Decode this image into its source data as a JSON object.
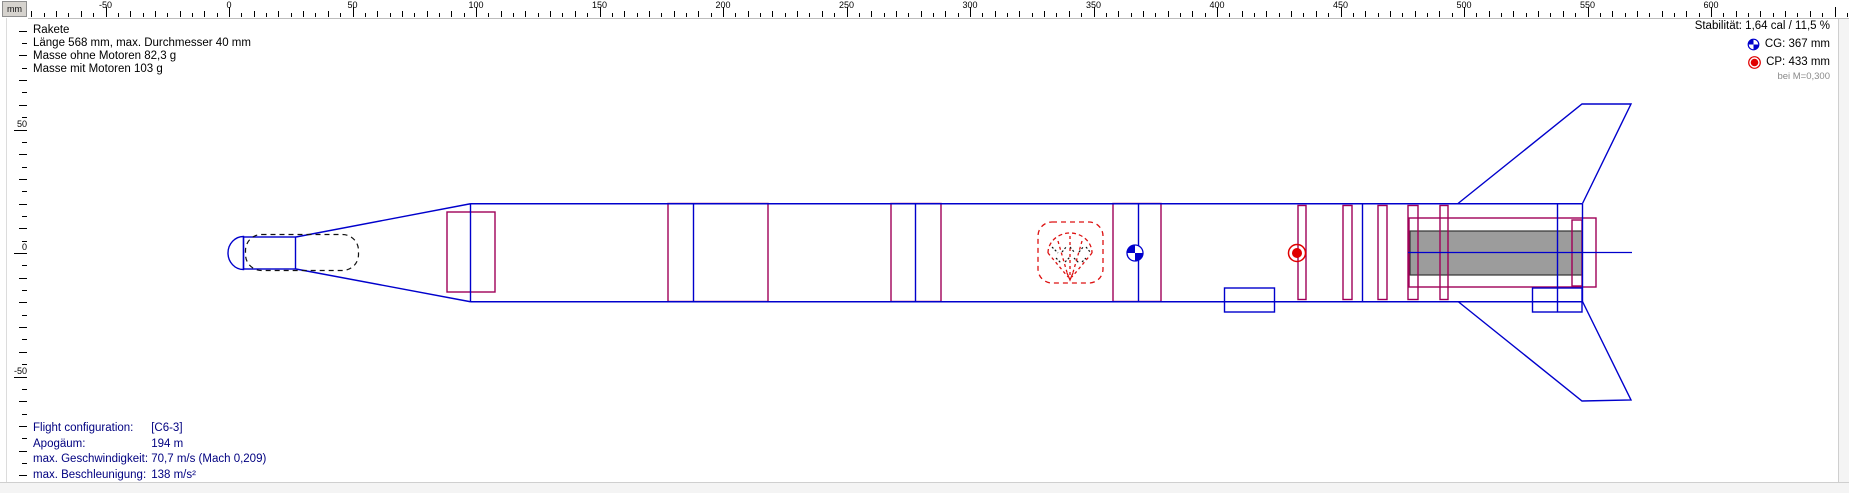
{
  "header": {
    "title": "Rakete",
    "info_lines": [
      "Länge 568 mm, max. Durchmesser 40 mm",
      "Masse ohne Motoren 82,3 g",
      "Masse mit Motoren 103 g"
    ]
  },
  "stability": {
    "stability_text": "Stabilität: 1,64 cal / 11,5 %",
    "cg_label": "CG: 367 mm",
    "cp_label": "CP: 433 mm",
    "mach_note": "bei M=0,300",
    "cg_value_mm": 367,
    "cp_value_mm": 433
  },
  "flight": {
    "rows": [
      {
        "label": "Flight configuration:",
        "value": "[C6-3]"
      },
      {
        "label": "Apogäum:",
        "value": "194 m"
      },
      {
        "label": "max. Geschwindigkeit:",
        "value": "70,7 m/s  (Mach 0,209)"
      },
      {
        "label": "max. Beschleunigung:",
        "value": "138 m/s²"
      }
    ]
  },
  "ruler": {
    "unit": "mm",
    "h_labels": [
      -50,
      0,
      50,
      100,
      150,
      200,
      250,
      300,
      350,
      400,
      450,
      500,
      550,
      600
    ],
    "v_labels": [
      50,
      0,
      -50
    ]
  },
  "icons": {
    "cg_icon": "cg-quartered-circle",
    "cp_icon": "cp-red-dot"
  },
  "colors": {
    "blue": "#0000cc",
    "red": "#a00058",
    "pred": "#dd1111",
    "motor_fill": "#9c9c9c",
    "navy": "#000080",
    "note_gray": "#8a8a8a"
  }
}
